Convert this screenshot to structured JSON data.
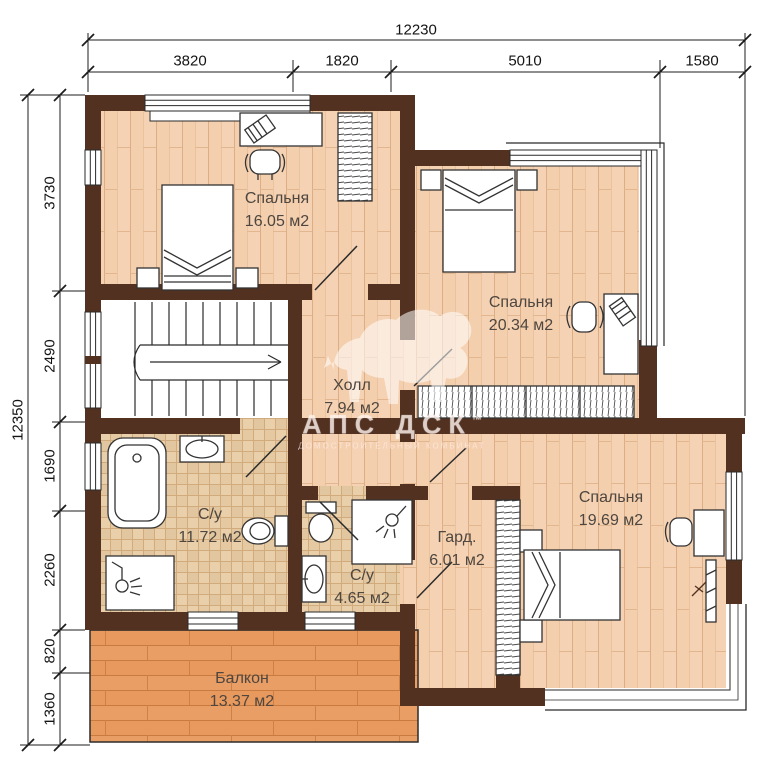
{
  "dimensions": {
    "top": {
      "overall": "12230",
      "segments": [
        "3820",
        "1820",
        "5010",
        "1580"
      ]
    },
    "left": {
      "overall": "12350",
      "segments": [
        "3730",
        "2490",
        "1690",
        "2260",
        "820",
        "1360"
      ]
    }
  },
  "rooms": [
    {
      "id": "bedroom-1",
      "name": "Спальня",
      "area": "16.05 м2"
    },
    {
      "id": "bedroom-2",
      "name": "Спальня",
      "area": "20.34 м2"
    },
    {
      "id": "hall",
      "name": "Холл",
      "area": "7.94 м2"
    },
    {
      "id": "bathroom-1",
      "name": "С/у",
      "area": "11.72 м2"
    },
    {
      "id": "bathroom-2",
      "name": "С/у",
      "area": "4.65 м2"
    },
    {
      "id": "wardrobe",
      "name": "Гард.",
      "area": "6.01 м2"
    },
    {
      "id": "bedroom-3",
      "name": "Спальня",
      "area": "19.69 м2"
    },
    {
      "id": "balcony",
      "name": "Балкон",
      "area": "13.37 м2"
    }
  ],
  "watermark": {
    "brand": "АПС ДСК",
    "tm": "™",
    "subtitle": "ДОМОСТРОИТЕЛЬНЫЙ КОМБИНАТ"
  },
  "colors": {
    "wall": "#523121",
    "wood": "#f4cfae",
    "tile": "#ead0aa",
    "deck": "#e8995e"
  }
}
